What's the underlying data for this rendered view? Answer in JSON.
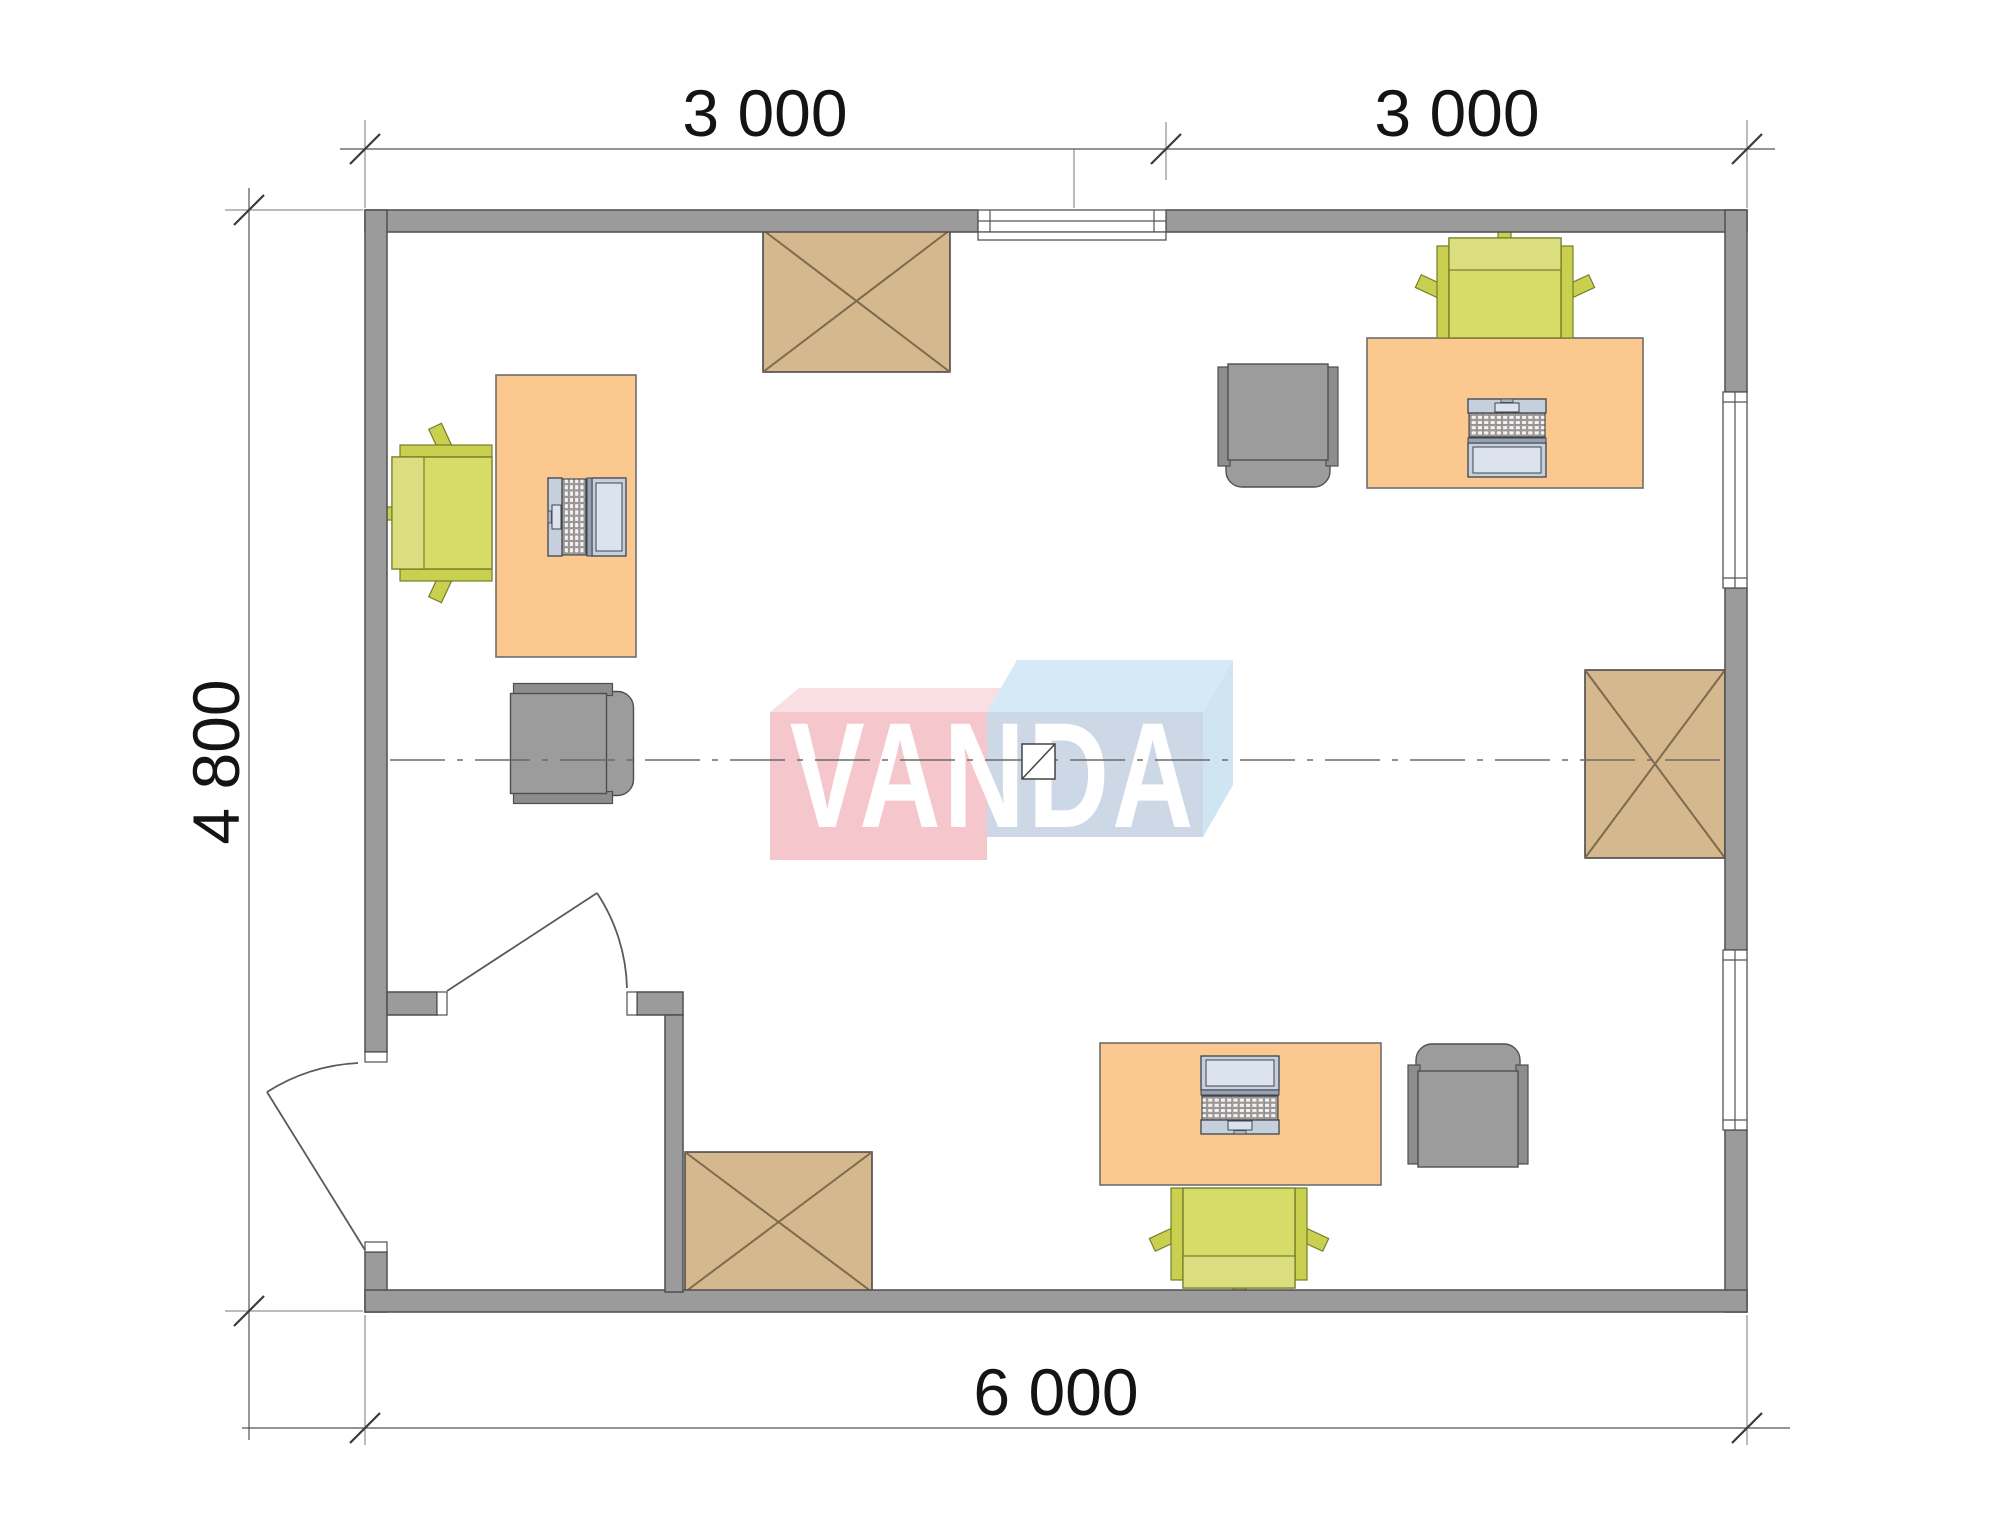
{
  "page": {
    "title": "Office floor plan with VANDA watermark"
  },
  "dimensions": {
    "top_segment_1": "3 000",
    "top_segment_2": "3 000",
    "side_height": "4 800",
    "bottom_width": "6 000"
  },
  "logo": {
    "text": "VANDA"
  },
  "furniture": {
    "desks": [
      "desk-left",
      "desk-top-right",
      "desk-bottom"
    ],
    "laptops": [
      "laptop-left",
      "laptop-top-right",
      "laptop-bottom"
    ],
    "task_chairs": [
      "task-chair-left",
      "task-chair-top-right",
      "task-chair-bottom"
    ],
    "armchairs": [
      "armchair-left",
      "armchair-top-right",
      "armchair-bottom-right"
    ],
    "crossed_tables": [
      "table-top-left",
      "table-right",
      "table-bottom-left"
    ],
    "doors": [
      "entrance-door",
      "vestibule-door"
    ],
    "windows": [
      "window-top",
      "window-right-upper",
      "window-right-lower"
    ]
  },
  "colors": {
    "wall": "#9b9b9b",
    "wall-line": "#4f4f4f",
    "desk": "#fbc88f",
    "wood": "#d5b88e",
    "wood-line": "#7d6b4e",
    "chair": "#d6dc68",
    "chair-back": "#dade7e",
    "chair-wing": "#c9d050",
    "chair-line": "#767d2a",
    "gray-chair": "#9c9c9c",
    "gray-chair-wing": "#8d8d8d",
    "laptop-body": "#c6cfdc",
    "laptop-screen": "#dde3ec",
    "logo-pink": "#f5c6cb",
    "logo-pink-top": "#f9dfe2",
    "logo-blue": "#cdd8e6",
    "logo-blue-top": "#d5eaf6",
    "logo-blue-side": "#cfe6f2",
    "dim-text": "#141414",
    "dim-line": "#555555"
  }
}
